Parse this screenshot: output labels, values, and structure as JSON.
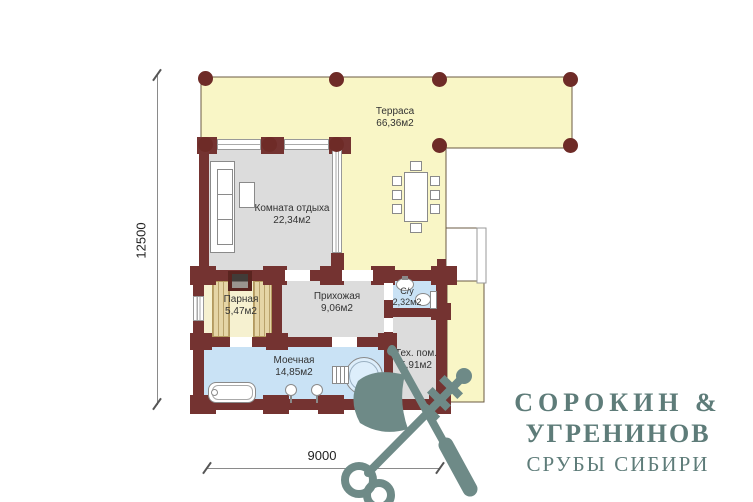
{
  "plan": {
    "rooms": [
      {
        "id": "terrace",
        "name": "Терраса",
        "area": "66,36м2"
      },
      {
        "id": "rest-room",
        "name": "Комната отдыха",
        "area": "22,34м2"
      },
      {
        "id": "steam-room",
        "name": "Парная",
        "area": "5,47м2"
      },
      {
        "id": "hallway",
        "name": "Прихожая",
        "area": "9,06м2"
      },
      {
        "id": "bathroom",
        "name": "С/у",
        "area": "2,32м2"
      },
      {
        "id": "washing-room",
        "name": "Моечная",
        "area": "14,85м2"
      },
      {
        "id": "tech-room",
        "name": "Тех. пом.",
        "area": "5,91м2"
      }
    ],
    "dimensions": {
      "height_mm": "12500",
      "width_mm": "9000"
    }
  },
  "brand": {
    "name_line1": "СОРОКИН &",
    "name_line2": "УГРЕНИНОВ",
    "tagline": "СРУБЫ СИБИРИ"
  },
  "colors": {
    "wall": "#743331",
    "column": "#6e2b27",
    "terrace_floor": "#f9f6c6",
    "room_floor": "#dcdcdc",
    "wet_floor": "#c9e2f5",
    "steam_floor": "#f6f1d0",
    "bench": "#e5d5a6",
    "brand": "#5e7c79",
    "emblem": "#6e8a87",
    "dimension": "#8a8a8a",
    "label": "#333333"
  }
}
